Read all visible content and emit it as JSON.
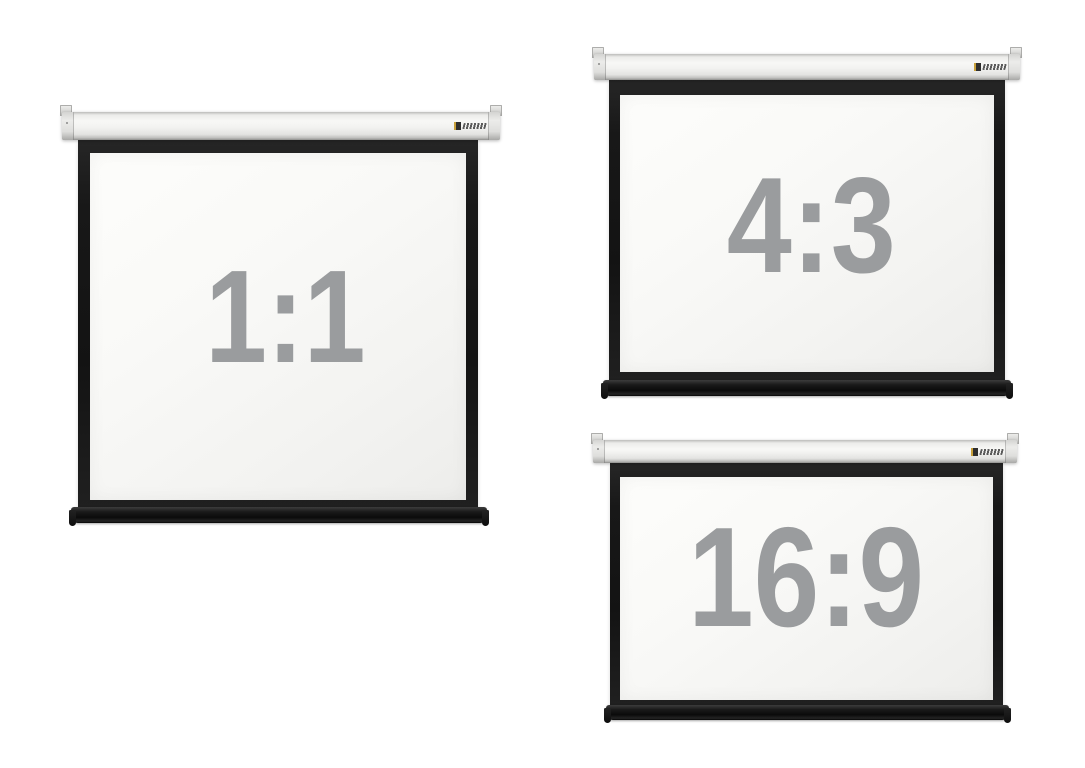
{
  "page": {
    "description": "Product photo collage of three roll-down projection screens showing available aspect ratios",
    "background": "#ffffff"
  },
  "screens": [
    {
      "id": "screen-1-1",
      "label": "1:1"
    },
    {
      "id": "screen-4-3",
      "label": "4:3"
    },
    {
      "id": "screen-16-9",
      "label": "16:9"
    }
  ],
  "brand_logo": {
    "icon": "brand-logo-mark",
    "mark_color": "#2e2e2e",
    "accent_color": "#c9a13b",
    "wordmark_color": "#3f3f3f"
  },
  "colors": {
    "background": "#ffffff",
    "label-gray": "#9a9c9e",
    "frame-black": "#181818",
    "housing-light": "#f8f8f6",
    "housing-edge": "#bcbcba",
    "housing-deep": "#8f8f8d",
    "surface-a": "#f9f9f7",
    "surface-b": "#ededeb",
    "weightbar": "#0a0a0a",
    "logo-mark": "#2e2e2e",
    "logo-accent": "#c9a13b",
    "logo-word": "#3f3f3f"
  }
}
